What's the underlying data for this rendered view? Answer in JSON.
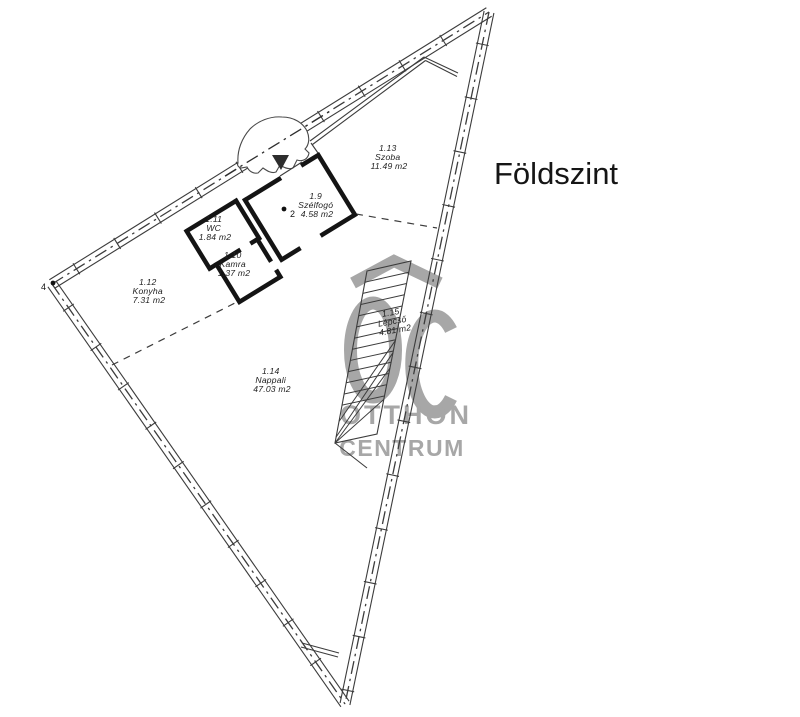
{
  "title": "Földszint",
  "rooms": [
    {
      "id": "1.9",
      "name": "Szélfogó",
      "area": "4.58 m2"
    },
    {
      "id": "1.10",
      "name": "Kamra",
      "area": "1.37 m2"
    },
    {
      "id": "1.11",
      "name": "WC",
      "area": "1.84 m2"
    },
    {
      "id": "1.12",
      "name": "Konyha",
      "area": "7.31 m2"
    },
    {
      "id": "1.13",
      "name": "Szoba",
      "area": "11.49 m2"
    },
    {
      "id": "1.14",
      "name": "Nappali",
      "area": "47.03 m2"
    },
    {
      "id": "1.15",
      "name": "Lépcső",
      "area": "4.81 m2"
    }
  ],
  "markers": {
    "entrance_point": "2",
    "boundary_point": "4"
  },
  "watermark": {
    "line1": "OTTHON",
    "line2": "CENTRUM",
    "color": "#a7a7a7"
  },
  "colors": {
    "background": "#ffffff",
    "line": "#3c3c3c",
    "wall": "#141414"
  }
}
